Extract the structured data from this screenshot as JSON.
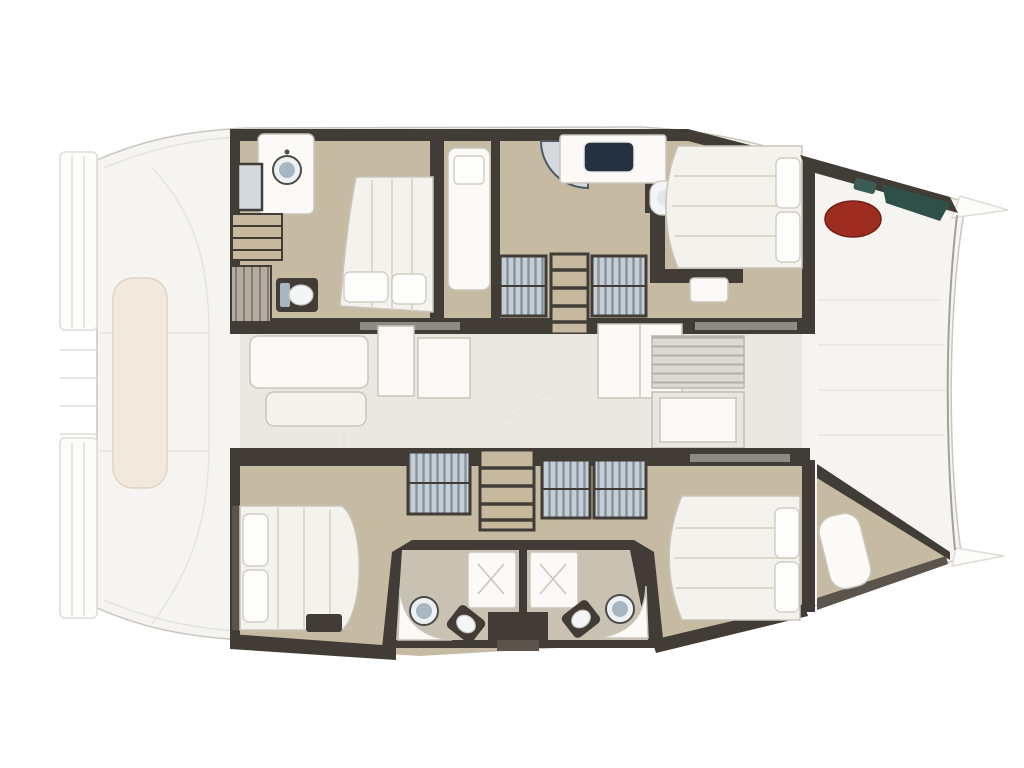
{
  "diagram": {
    "type": "floor-plan",
    "subject": "catamaran-yacht-deck-plan",
    "orientation": "bow-right",
    "areas": {
      "stern": [
        "swim-platform-port",
        "swim-platform-starboard",
        "davit-lines",
        "aft-cockpit-bench",
        "aft-cockpit"
      ],
      "port_hull": [
        "aft-head",
        "aft-head-shower",
        "companionway-steps",
        "hanging-lockers",
        "aft-toilet",
        "mid-cabin-double-bed",
        "single-berth",
        "forward-head-shower",
        "forward-head-vanity",
        "forward-head-toilet",
        "companionway-ladder",
        "deck-hatch-left",
        "deck-hatch-right",
        "forward-cabin-double-bed"
      ],
      "bridgedeck": [
        "saloon-floor",
        "cockpit-table",
        "cockpit-bench",
        "galley-unit-left",
        "galley-unit-right",
        "tall-cabinet",
        "vent-unit",
        "aft-galley-cabinet",
        "forward-bulkhead"
      ],
      "starboard_hull": [
        "aft-cabin-double-bed",
        "deck-hatch-aft",
        "companionway-ladder",
        "deck-hatch-mid-left",
        "deck-hatch-mid-right",
        "twin-heads-block",
        "shower-left",
        "shower-right",
        "sink-left",
        "sink-right",
        "toilet-left",
        "toilet-right",
        "forward-cabin-double-bed",
        "bow-locker-berth"
      ],
      "bow": [
        "foredeck-planks",
        "bow-cockpit-bench",
        "bow-round-table",
        "bow-cushions-teal",
        "bowsprit-pennant-top",
        "bowsprit-pennant-bottom"
      ]
    },
    "counts": {
      "double-beds": 4,
      "single-berths": 2,
      "heads": 4,
      "showers": 4,
      "round-sinks": 3,
      "ladders": 2,
      "deck-hatches": 5
    }
  },
  "palette": {
    "bg": "#ffffff",
    "deck": "#f5f4f1",
    "deck_line": "#c9c6c0",
    "deck_inner_line": "#e5e3de",
    "platform": "#fcfcfb",
    "platform_line": "#dfdcd6",
    "bench_cream": "#f0e9dc",
    "bench_cream_line": "#ded5c2",
    "wall": "#413c36",
    "wall_light": "#5a544c",
    "floor_tan": "#c7baa2",
    "floor_tan_light": "#cfc3ae",
    "speckle_floor": "#c9c2b2",
    "saloon_floor": "#ebe8e2",
    "furniture_white": "#fbfaf7",
    "furniture_line": "#c9c5bb",
    "bed_cream": "#f4f2ec",
    "quilt_line": "#ddd8cc",
    "pillow_white": "#fdfdfb",
    "hatch_blue": "#c5ced5",
    "hatch_stripe": "#87929d",
    "ladder_tan": "#c7b99e",
    "sink_white": "#eef1f3",
    "sink_blue": "#a7b7c2",
    "sink_ring": "#4d4c48",
    "navy_sink": "#243140",
    "shower_glass": "#d3d9dd",
    "shower_glass_line": "#4e5a64",
    "toilet_white": "#f3f5f6",
    "toilet_inner": "#e2e6e8",
    "window_slot": "#8e8b85",
    "red_table": "#9d2d21",
    "red_table_edge": "#701f16",
    "teal_dark": "#2f5049",
    "teal_light": "#3c5d55",
    "plank_line": "#e7e5e0",
    "bow_curve": "#a3a09a",
    "gray_unit": "#dcdad5",
    "gray_unit_stripe": "#b3afa8",
    "gray_unit_line": "#b9b5ae",
    "gray_cabinet": "#e8e6e1",
    "gray_cabinet_line": "#c2beb6",
    "locker_gray": "#b3ada1",
    "locker_line": "#847e70"
  }
}
